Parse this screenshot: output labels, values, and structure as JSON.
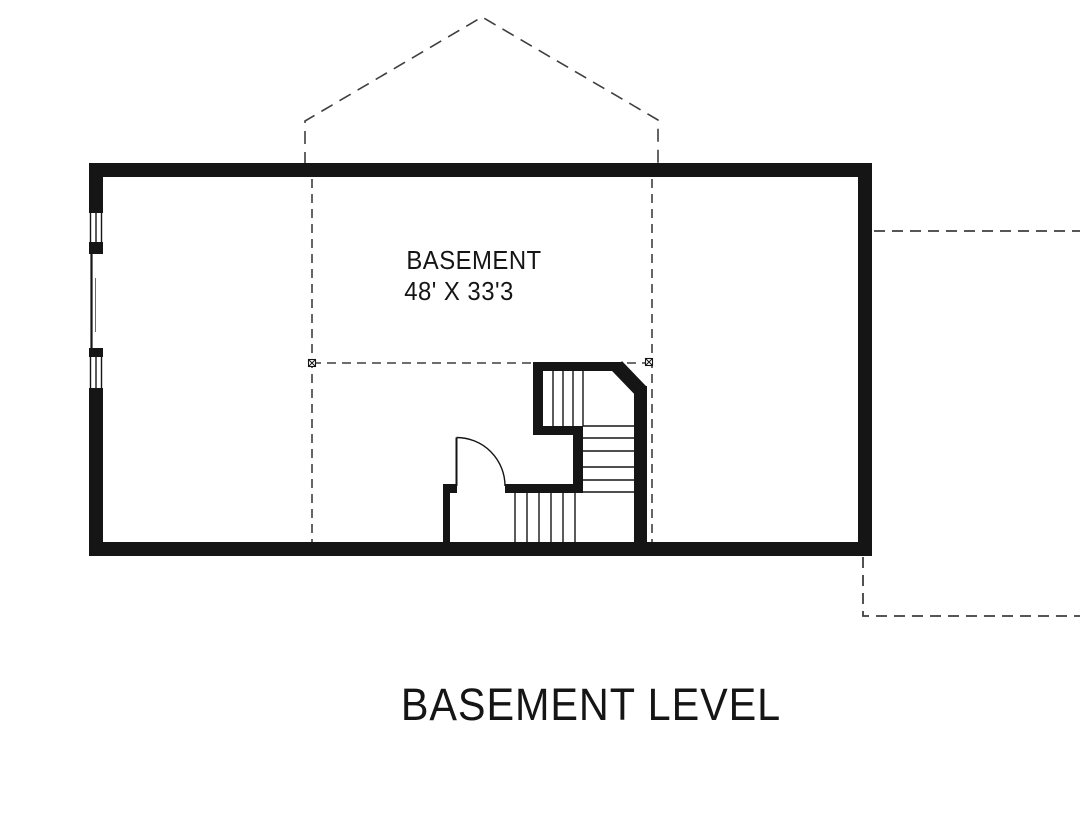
{
  "plan": {
    "room_label": "BASEMENT",
    "room_dimensions": "48' X 33'3",
    "title": "BASEMENT LEVEL"
  },
  "colors": {
    "background": "#ffffff",
    "line": "#151515",
    "dashed_line": "#3f3f3f"
  }
}
